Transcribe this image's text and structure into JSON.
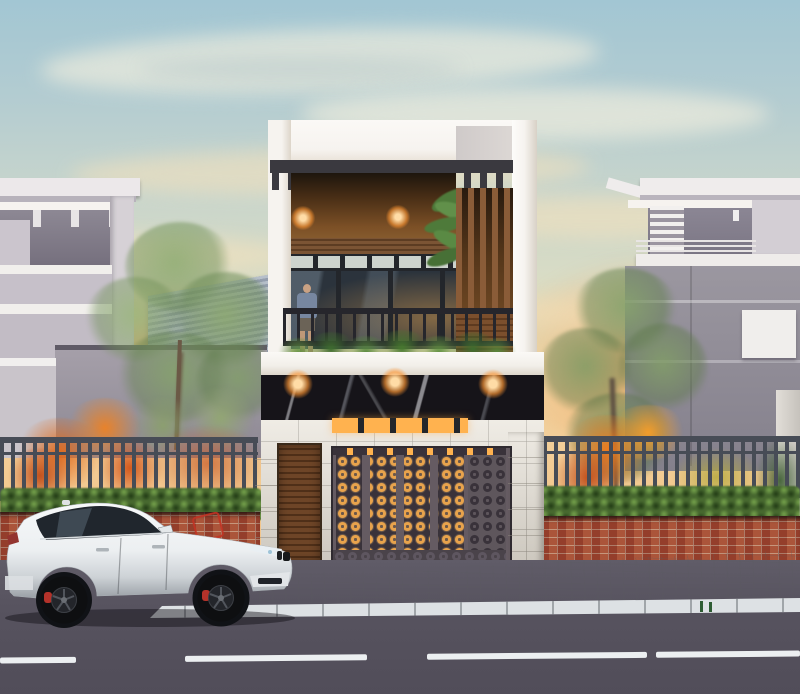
{
  "scene": {
    "description": "sunset architectural render of a modern two-storey townhouse with patterned metal gate, balcony with plants and a person, neighbouring villas, street fence with brick base, white SUV parked on the road",
    "time_of_day": "sunset",
    "main_house": {
      "storeys": 2,
      "ceiling_downlights": 2,
      "soffit_downlights": 3,
      "balcony_person": 1,
      "gate_style": "laser-cut chain pattern, warm backlight"
    },
    "vehicle": {
      "type": "SUV",
      "body_color_name": "white",
      "facing": "right",
      "wheels": 2,
      "brake_caliper_color_name": "red"
    },
    "street": {
      "lane_marking": "white dashed line",
      "dash_count": 4
    },
    "fence": {
      "base": "red brick wall",
      "top": "dark vertical steel bars",
      "hedge": "green",
      "shrubs": "orange"
    }
  },
  "palette": {
    "sky-top": "#a2c6d3",
    "sky-mid": "#d9dcc5",
    "sky-warm": "#f0d3a2",
    "sky-horizon": "#f2c68c",
    "cloud-cream": "rgba(246,240,222,0.62)",
    "cloud-warm": "rgba(246,226,188,0.55)",
    "glow-orange": "rgba(243,172,102,0.85)",
    "frame-white": "#f6f3ef",
    "slab-white": "#f2efe9",
    "neighbor-left": "#cbc5cd",
    "neighbor-left-dark": "#756f7d",
    "neighbor-right": "#9b97a0",
    "neighbor-right-light": "#d3ced4",
    "roof-metal-a": "#b6bfca",
    "roof-metal-b": "#949eae",
    "pergola-dark": "#3a393f",
    "wood-ceiling-a": "#1d150d",
    "wood-ceiling-b": "#7c5026",
    "wood-slat": "#7b5434",
    "wood-louver": "#8a5c38",
    "wood-door": "#6e4527",
    "glass-dark": "#2b333c",
    "frame-dark": "#23262b",
    "rail-dark": "#26262c",
    "warm-light": "#ffb24f",
    "lamp-core": "#ffdca6",
    "marble-black": "#161419",
    "stone-tile": "#e9e4da",
    "stone-joint": "rgba(140,135,125,0.5)",
    "gate-metal": "#655b62",
    "gate-dark": "#39323a",
    "gate-glow": "#e8a34c",
    "fence-dark": "#474c56",
    "hedge-green": "#47682f",
    "hedge-light": "#76a34c",
    "brick-red": "#a34a35",
    "brick-mortar": "rgba(210,190,170,0.8)",
    "tree-green": "#86a46e",
    "tree-dark": "#5d7a4a",
    "trunk-brown": "#6b5946",
    "shrub-orange": "#e06c1f",
    "shrub-orange-deep": "#c2511d",
    "shrub-yellow": "#b5a93e",
    "road-asphalt": "#57535f",
    "road-asphalt-light": "#605c68",
    "sidewalk-gray": "#b9bdc3",
    "curb-white": "#dde1e4",
    "lane-white": "#eceff1",
    "car-white": "#f2f4f6",
    "car-shade": "#9aa0a6",
    "wheel-dark": "#0e0f11",
    "caliper-red": "#b4322a",
    "skin": "#c9a183",
    "shirt-blue": "#7787a0",
    "shorts-dark": "#6b6357",
    "bike-red": "#c23324",
    "drain-green": "#2e5c33"
  }
}
